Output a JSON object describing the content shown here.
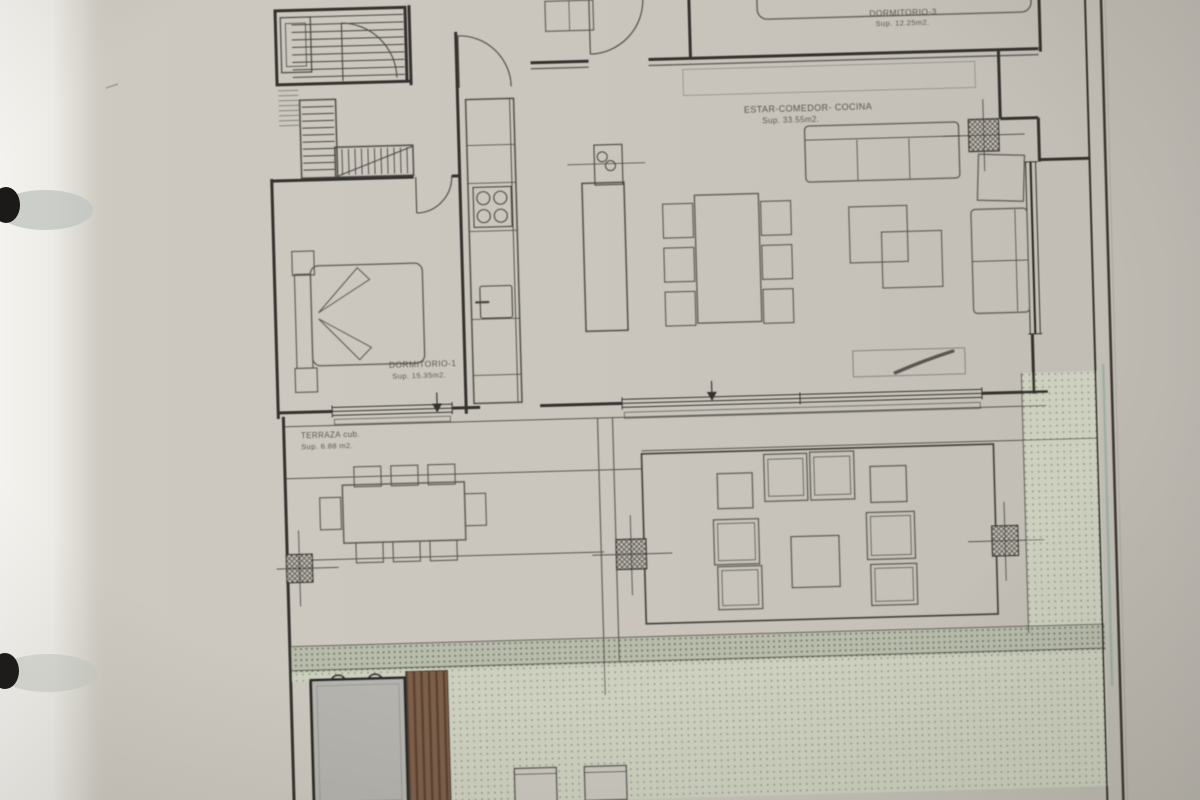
{
  "plan": {
    "rooms": [
      {
        "label": "DORMITORIO-3",
        "area": "Sup. 12.25m2."
      },
      {
        "label": "ESTAR-COMEDOR- COCINA",
        "area": "Sup. 33.55m2."
      },
      {
        "label": "DORMITORIO-1",
        "area": "Sup. 15.35m2."
      },
      {
        "label": "TERRAZA cub.",
        "area": "Sup. 6.88 m2."
      }
    ],
    "palette": {
      "paper": "#cac6be",
      "wall_ink": "#34332e",
      "furniture_line": "#57564f",
      "stipple_dot": "#8e947e",
      "stipple_bg": "#cdd0bf",
      "deck_wood": "#7c5e48",
      "deck_stripe": "#5a4232",
      "pool_slab": "#b5b3ae",
      "boundary_green": "#93af9f",
      "margin_white": "#f2f1ee",
      "binder_dot": "#1b1a18"
    }
  }
}
